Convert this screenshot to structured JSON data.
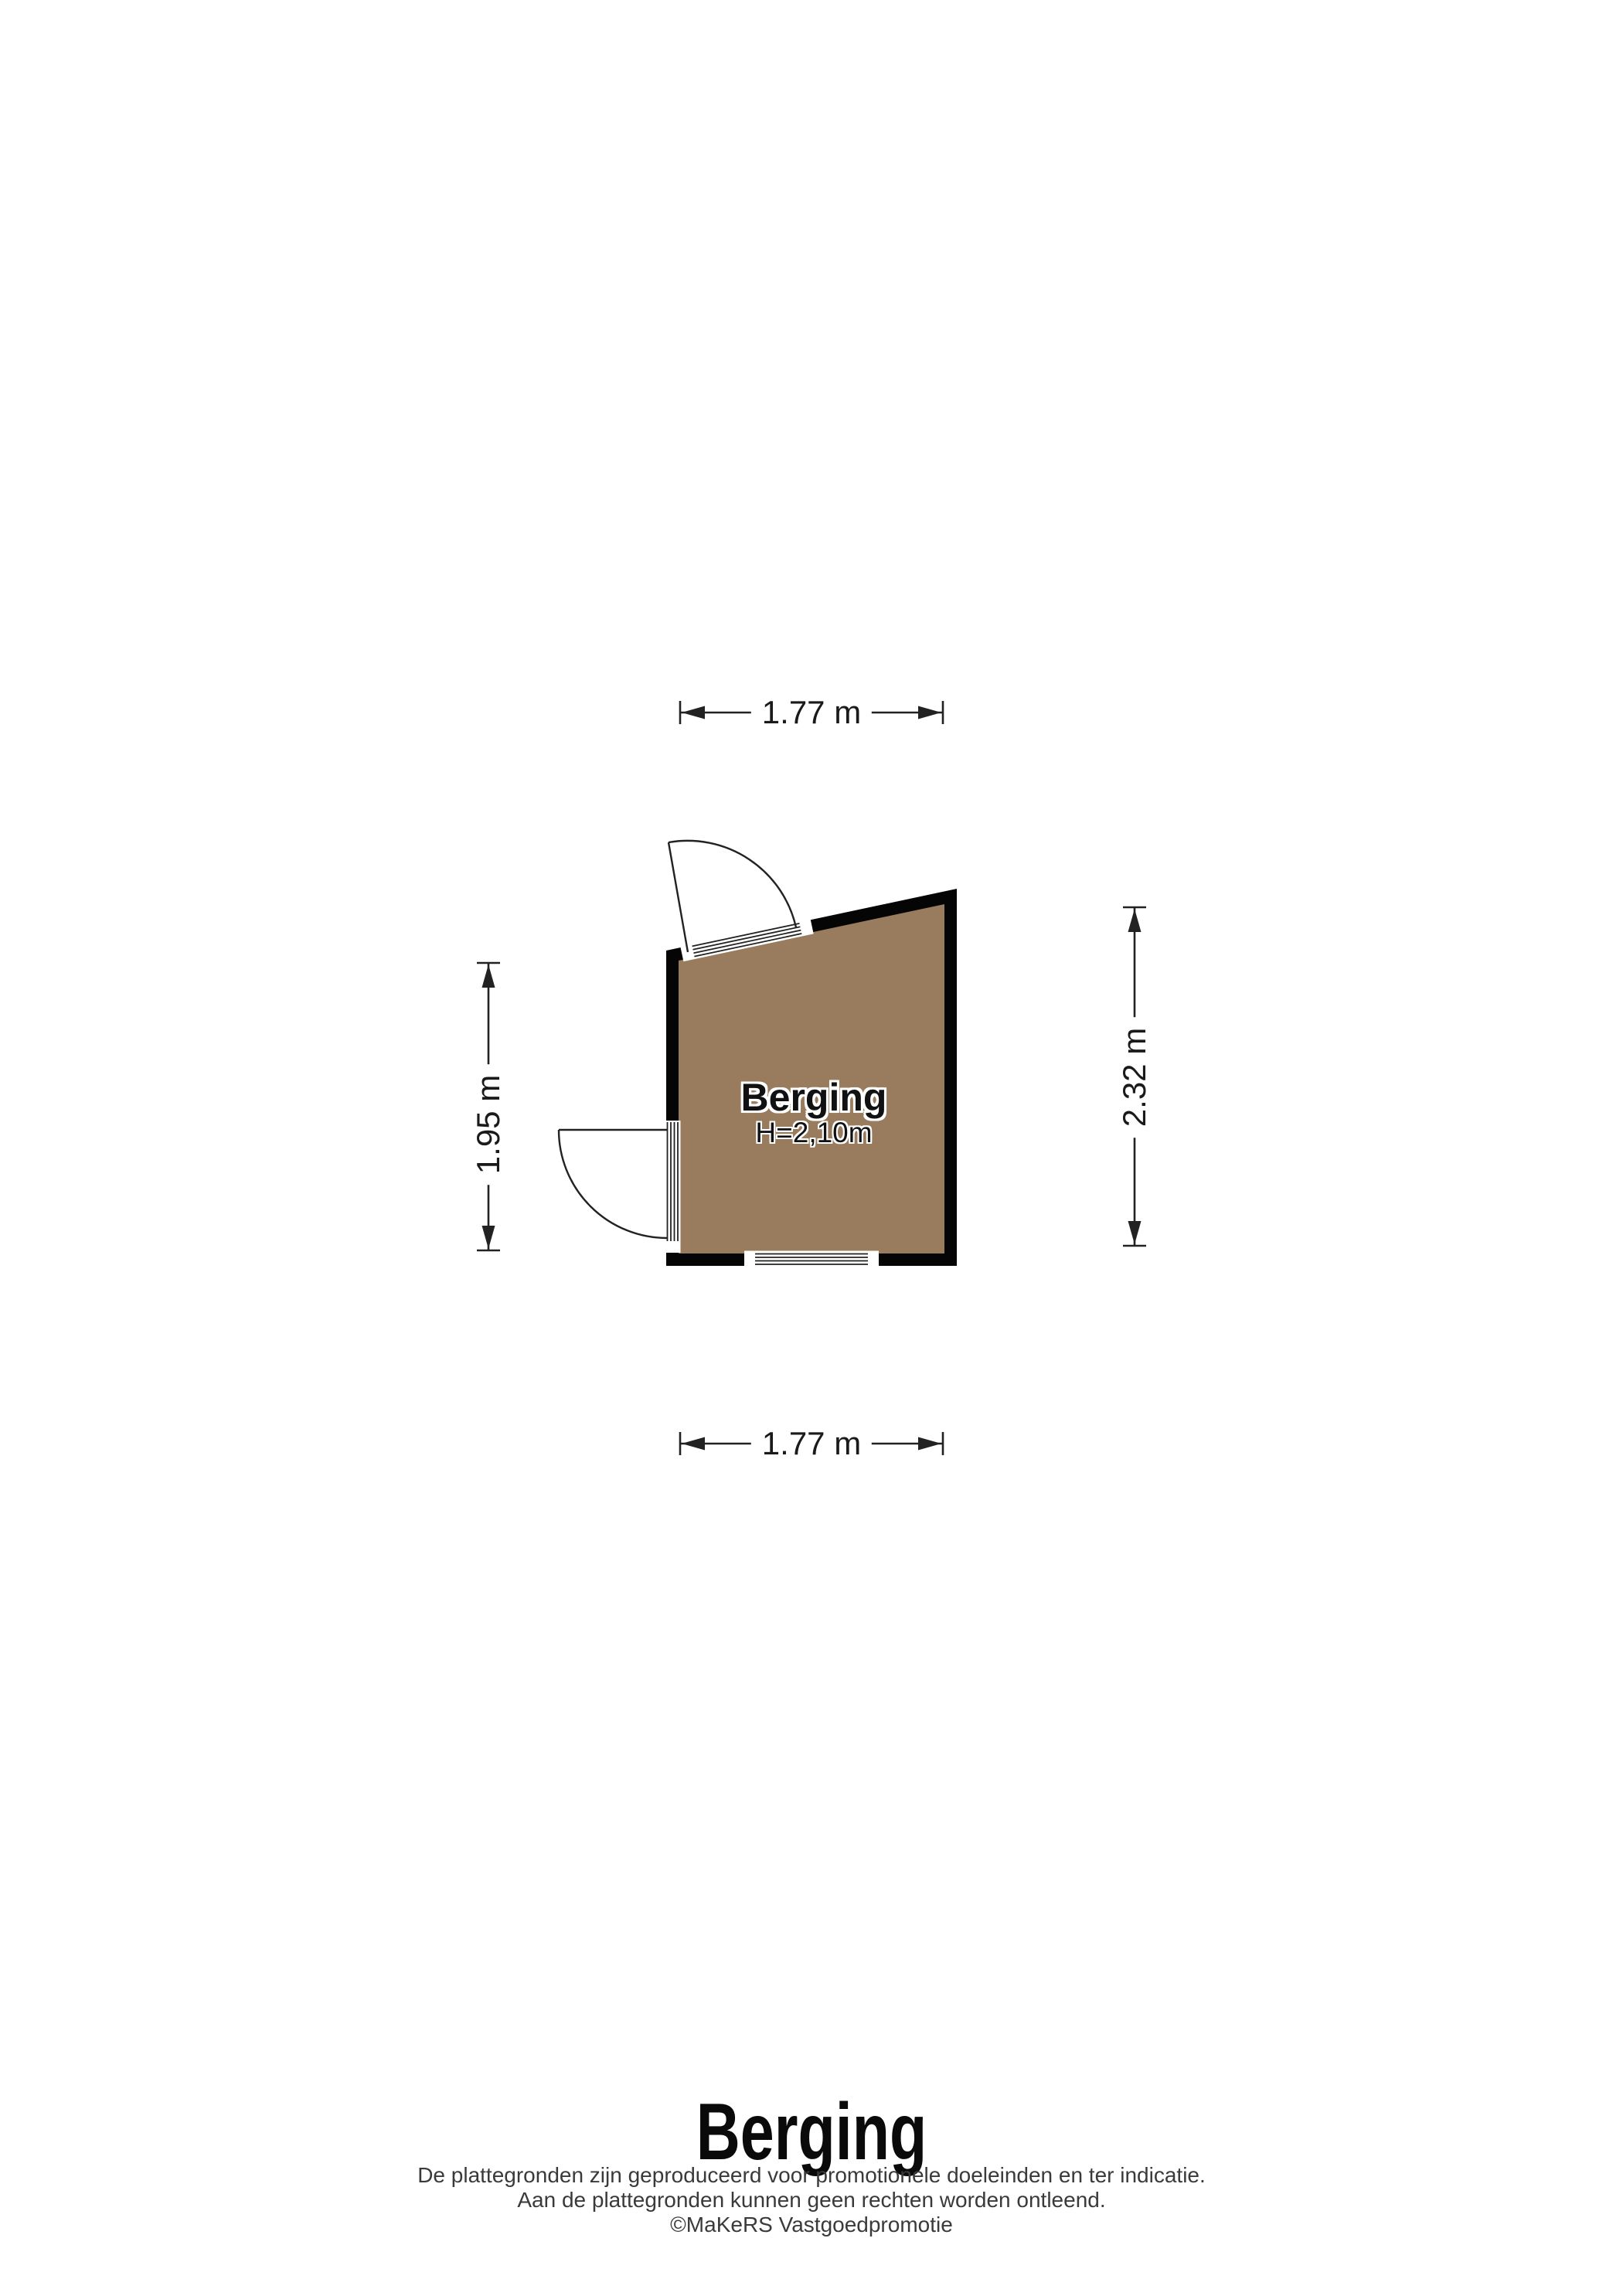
{
  "plan": {
    "room": {
      "label": "Berging",
      "ceiling_height": "H=2,10m"
    },
    "dimensions": {
      "top": "1.77 m",
      "bottom": "1.77 m",
      "left": "1.95 m",
      "right": "2.32 m"
    },
    "colors": {
      "floor": "#997c5d",
      "wall": "#050505",
      "line": "#222222"
    }
  },
  "footer": {
    "title": "Berging",
    "lines": [
      "De plattegronden zijn geproduceerd voor promotionele doeleinden en ter indicatie.",
      "Aan de plattegronden kunnen geen rechten worden ontleend.",
      "©MaKeRS Vastgoedpromotie"
    ]
  }
}
